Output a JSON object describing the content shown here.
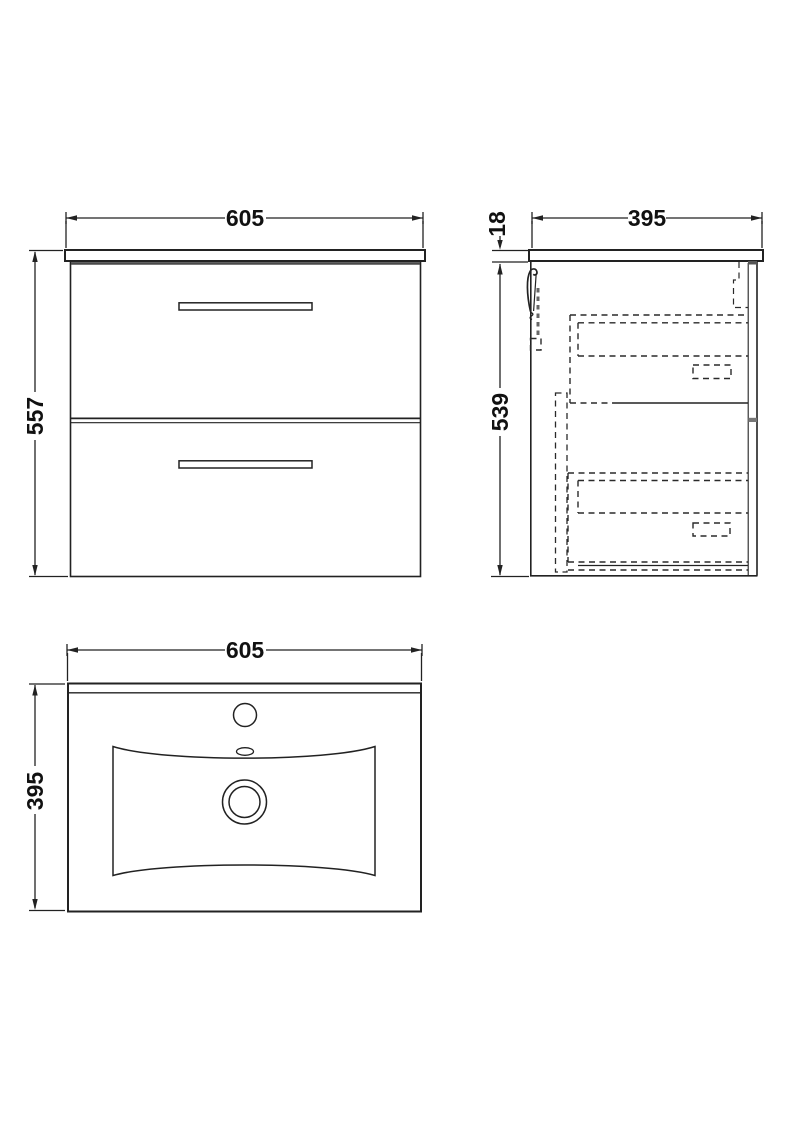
{
  "drawing": {
    "front_view": {
      "width_label": "605",
      "height_label": "557"
    },
    "side_view": {
      "depth_label": "395",
      "worktop_thickness_label": "18",
      "cabinet_height_label": "539"
    },
    "plan_view": {
      "width_label": "605",
      "depth_label": "395"
    }
  },
  "colors": {
    "line": "#222222",
    "soft_line": "#555555",
    "background": "#ffffff"
  }
}
